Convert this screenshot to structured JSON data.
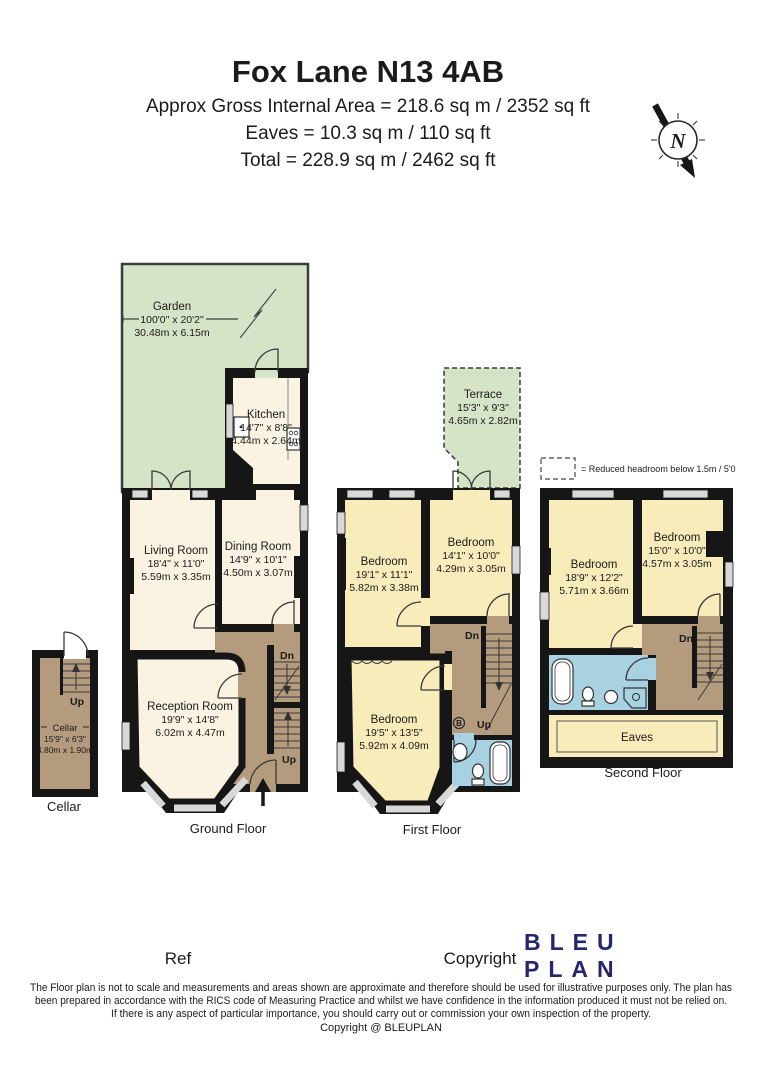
{
  "header": {
    "title": "Fox Lane N13 4AB",
    "area_line": "Approx Gross Internal Area = 218.6 sq m / 2352 sq ft",
    "eaves_line": "Eaves = 10.3 sq m / 110 sq ft",
    "total_line": "Total = 228.9 sq m / 2462 sq ft"
  },
  "compass": {
    "label": "N"
  },
  "legend": {
    "text": "= Reduced headroom below 1.5m / 5'0"
  },
  "garden": {
    "name": "Garden",
    "imperial": "100'0\" x 20'2\"",
    "metric": "30.48m x 6.15m"
  },
  "ground_floor": {
    "caption": "Ground Floor",
    "kitchen": {
      "name": "Kitchen",
      "imperial": "14'7\" x 8'8\"",
      "metric": "4.44m x 2.64m"
    },
    "living_room": {
      "name": "Living Room",
      "imperial": "18'4\" x 11'0\"",
      "metric": "5.59m x 3.35m"
    },
    "dining_room": {
      "name": "Dining Room",
      "imperial": "14'9\" x 10'1\"",
      "metric": "4.50m x 3.07m"
    },
    "reception_room": {
      "name": "Reception Room",
      "imperial": "19'9\" x 14'8\"",
      "metric": "6.02m x 4.47m"
    },
    "stairs_dn": "Dn",
    "stairs_up": "Up"
  },
  "cellar": {
    "caption": "Cellar",
    "name": "Cellar",
    "imperial": "15'9\" x 6'3\"",
    "metric": "4.80m x 1.90m",
    "stairs_up": "Up"
  },
  "first_floor": {
    "caption": "First Floor",
    "terrace": {
      "name": "Terrace",
      "imperial": "15'3\" x 9'3\"",
      "metric": "4.65m x 2.82m"
    },
    "bedroom_left": {
      "name": "Bedroom",
      "imperial": "19'1\" x 11'1\"",
      "metric": "5.82m x 3.38m"
    },
    "bedroom_right": {
      "name": "Bedroom",
      "imperial": "14'1\" x 10'0\"",
      "metric": "4.29m x 3.05m"
    },
    "bedroom_front": {
      "name": "Bedroom",
      "imperial": "19'5\" x 13'5\"",
      "metric": "5.92m x 4.09m"
    },
    "stairs_dn": "Dn",
    "stairs_up": "Up",
    "boiler": "B"
  },
  "second_floor": {
    "caption": "Second Floor",
    "bedroom_left": {
      "name": "Bedroom",
      "imperial": "18'9\" x 12'2\"",
      "metric": "5.71m x 3.66m"
    },
    "bedroom_right": {
      "name": "Bedroom",
      "imperial": "15'0\" x 10'0\"",
      "metric": "4.57m x 3.05m"
    },
    "eaves_label": "Eaves",
    "stairs_dn": "Dn"
  },
  "footer": {
    "ref_label": "Ref",
    "copyright_label": "Copyright",
    "logo_line1": "BLEU",
    "logo_line2": "PLAN",
    "disclaimer_line1": "The Floor plan is not to scale and measurements and areas shown are approximate and therefore should be used for illustrative purposes only. The plan has",
    "disclaimer_line2": "been prepared in accordance with the RICS code of Measuring Practice and whilst we have confidence in the information produced it must not be relied on.",
    "disclaimer_line3": "If there is any aspect of particular importance, you should carry out or commission your own inspection of the property.",
    "copyright_line": "Copyright @ BLEUPLAN"
  },
  "colors": {
    "wall": "#161616",
    "room_cream": "#FAF3E1",
    "room_yellow": "#F8ECBB",
    "garden_green": "#D5E4C7",
    "hallway_brown": "#B49B7D",
    "bathroom_blue": "#A8D2E2",
    "window_grey": "#D8D8D8",
    "logo_navy": "#26266E"
  }
}
